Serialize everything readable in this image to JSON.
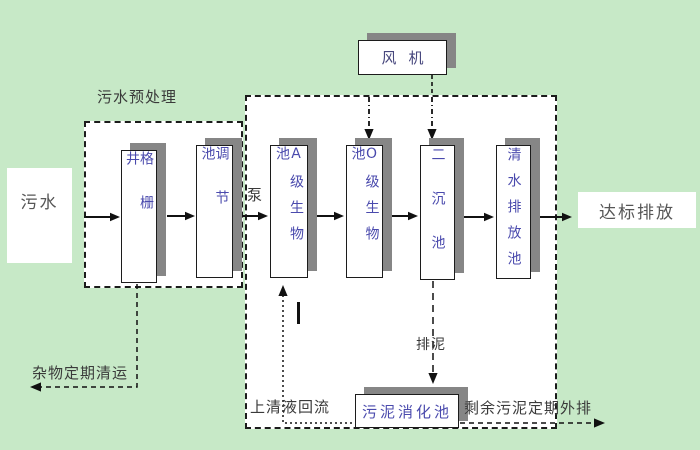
{
  "title": "污水处理工艺流程图",
  "colors": {
    "background": "#c7e9c7",
    "region_background": "#ffffff",
    "box_border": "#1c1c1c",
    "box_shadow": "#868686",
    "box_text": "#4a4aad",
    "label_text": "#3a3a3a",
    "line": "#111111"
  },
  "regions": {
    "pretreatment_title": "污水预处理"
  },
  "nodes": {
    "sewage_in": "污水",
    "grid_well": "格栅井",
    "regulating_tank": "调节池",
    "pump": "泵",
    "a_bio_tank": "A级生物池",
    "o_bio_tank": "O级生物池",
    "secondary_settling_tank": "二沉池",
    "clean_water_discharge_tank": "清水排放池",
    "fan": "风机",
    "sludge_digestion_tank": "污泥消化池",
    "discharge_out": "达标排放"
  },
  "flow_labels": {
    "debris_removal": "杂物定期清运",
    "supernatant_return": "上清液回流",
    "sludge_discharge": "排泥",
    "excess_sludge_out": "剩余污泥定期外排"
  }
}
